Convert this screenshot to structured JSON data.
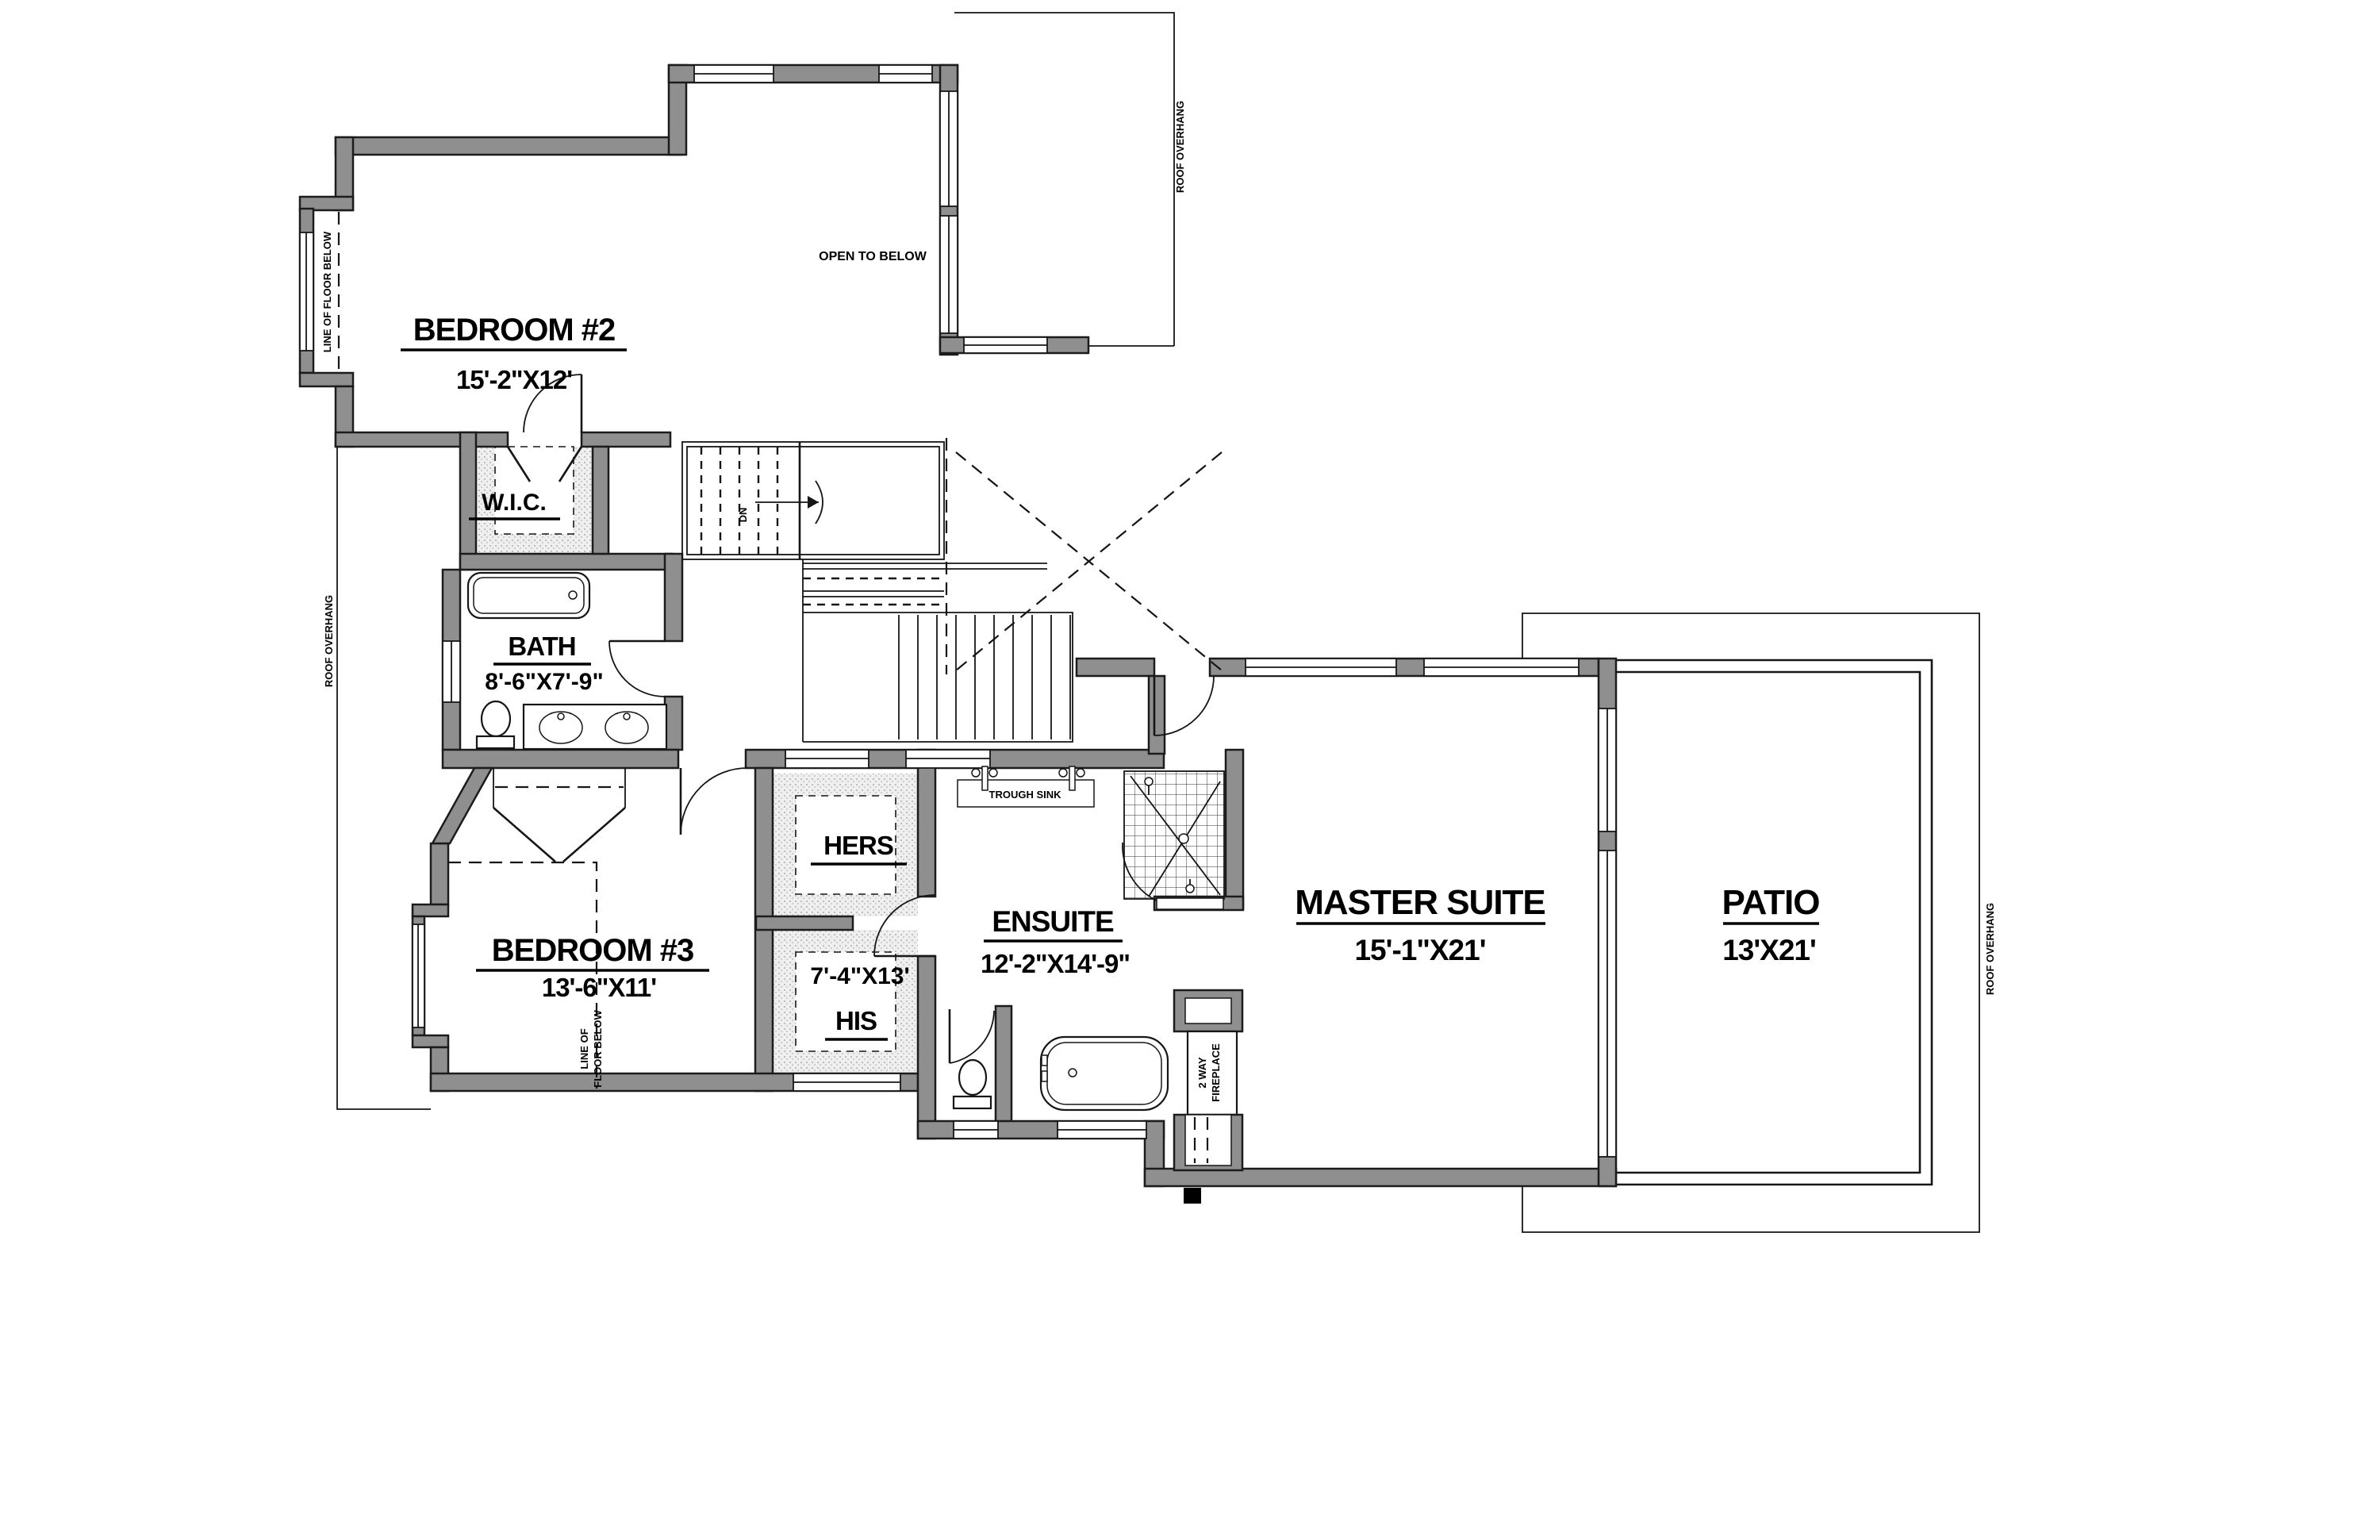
{
  "plan": {
    "rooms": {
      "bedroom2": {
        "name": "BEDROOM #2",
        "dims": "15'-2\"X12'"
      },
      "bedroom3": {
        "name": "BEDROOM #3",
        "dims": "13'-6\"X11'"
      },
      "wic": {
        "name": "W.I.C."
      },
      "bath": {
        "name": "BATH",
        "dims": "8'-6\"X7'-9\""
      },
      "hers": {
        "name": "HERS"
      },
      "his": {
        "name": "HIS",
        "dims": "7'-4\"X13'"
      },
      "ensuite": {
        "name": "ENSUITE",
        "dims": "12'-2\"X14'-9\""
      },
      "master": {
        "name": "MASTER SUITE",
        "dims": "15'-1\"X21'"
      },
      "patio": {
        "name": "PATIO",
        "dims": "13'X21'"
      }
    },
    "fixtures": {
      "trough_sink": "TROUGH SINK",
      "fireplace_l1": "2 WAY",
      "fireplace_l2": "FIREPLACE"
    },
    "stairs": {
      "down": "DN"
    },
    "annotations": {
      "open_to_below": "OPEN TO BELOW",
      "roof_overhang": "ROOF OVERHANG",
      "line_of_floor_below": "LINE OF FLOOR BELOW",
      "line_of_floor_below_l1": "LINE OF",
      "line_of_floor_below_l2": "FLOOR BELOW"
    },
    "colors": {
      "wall_fill": "#8f8f8f",
      "wall_stroke": "#1c1c1c",
      "background": "#ffffff",
      "line": "#161616"
    }
  }
}
